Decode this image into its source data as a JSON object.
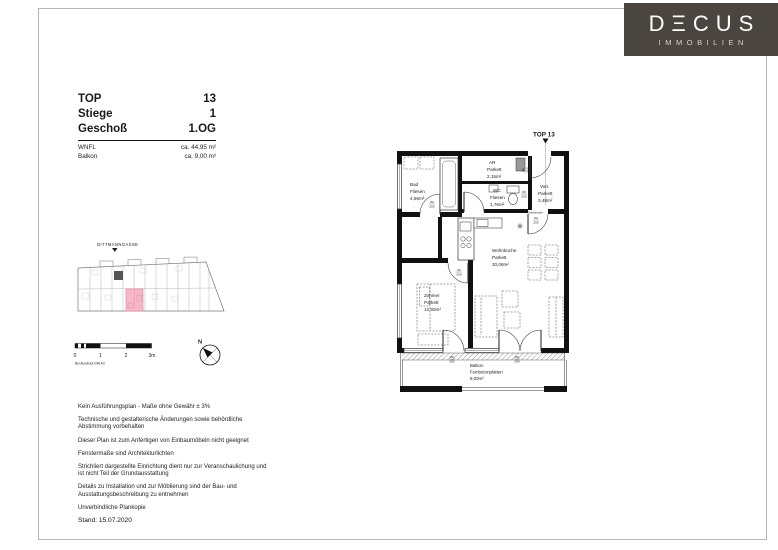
{
  "logo": {
    "brand": "DΞCUS",
    "subtitle": "IMMOBILIEN",
    "bg_color": "#4b4540"
  },
  "header": {
    "rows": [
      {
        "label": "TOP",
        "value": "13"
      },
      {
        "label": "Stiege",
        "value": "1"
      },
      {
        "label": "Geschoß",
        "value": "1.OG"
      }
    ],
    "area_rows": [
      {
        "label": "WNFL",
        "value": "ca. 44,95 m²"
      },
      {
        "label": "Balkon",
        "value": "ca. 9,00 m²"
      }
    ]
  },
  "site_plan": {
    "street": "DITTMANNGASSE",
    "highlight_color": "#f7b7c7"
  },
  "scale_bar": {
    "ticks": [
      "0",
      "1",
      "2",
      "3m"
    ],
    "note": "Bei Ausdruck DIN A3"
  },
  "compass": {
    "north": "N"
  },
  "floorplan": {
    "unit_marker": "TOP 13",
    "garderobe": "Garderobe",
    "door_dim": {
      "w": "80",
      "h": "200"
    },
    "rooms": [
      {
        "name": "Bad",
        "floor": "Fliesen",
        "area": "4,59m²"
      },
      {
        "name": "AR",
        "floor": "Parkett",
        "area": "2,15m²"
      },
      {
        "name": "WC",
        "floor": "Fliesen",
        "area": "1,76m²"
      },
      {
        "name": "Vorr.",
        "floor": "Parkett",
        "area": "3,48m²"
      },
      {
        "name": "Wohnküche",
        "floor": "Parkett",
        "area": "20,06m²"
      },
      {
        "name": "Zimmer",
        "floor": "Parkett",
        "area": "12,90m²"
      },
      {
        "name": "Balkon",
        "floor": "Feinbetonplatten",
        "area": "9,00m²"
      }
    ]
  },
  "disclaimers": [
    "Kein Ausführungsplan - Maße ohne Gewähr ± 3%",
    "Technische und gestalterische Änderungen sowie behördliche\nAbstimmung vorbehalten",
    "Dieser Plan ist zum Anfertigen von Einbaumöbeln nicht geeignet",
    "Fenstermaße sind Architekturlichten",
    "Strichliert dargestellte Einrichtung dient nur zur Veranschaulichung und\nist nicht Teil der Grundausstattung",
    "Details zu Installation und zur Möblierung sind der Bau- und\nAusstattungsbeschreibung zu entnehmen",
    "Unverbindliche Plankopie"
  ],
  "date_label": "Stand: 15.07.2020"
}
